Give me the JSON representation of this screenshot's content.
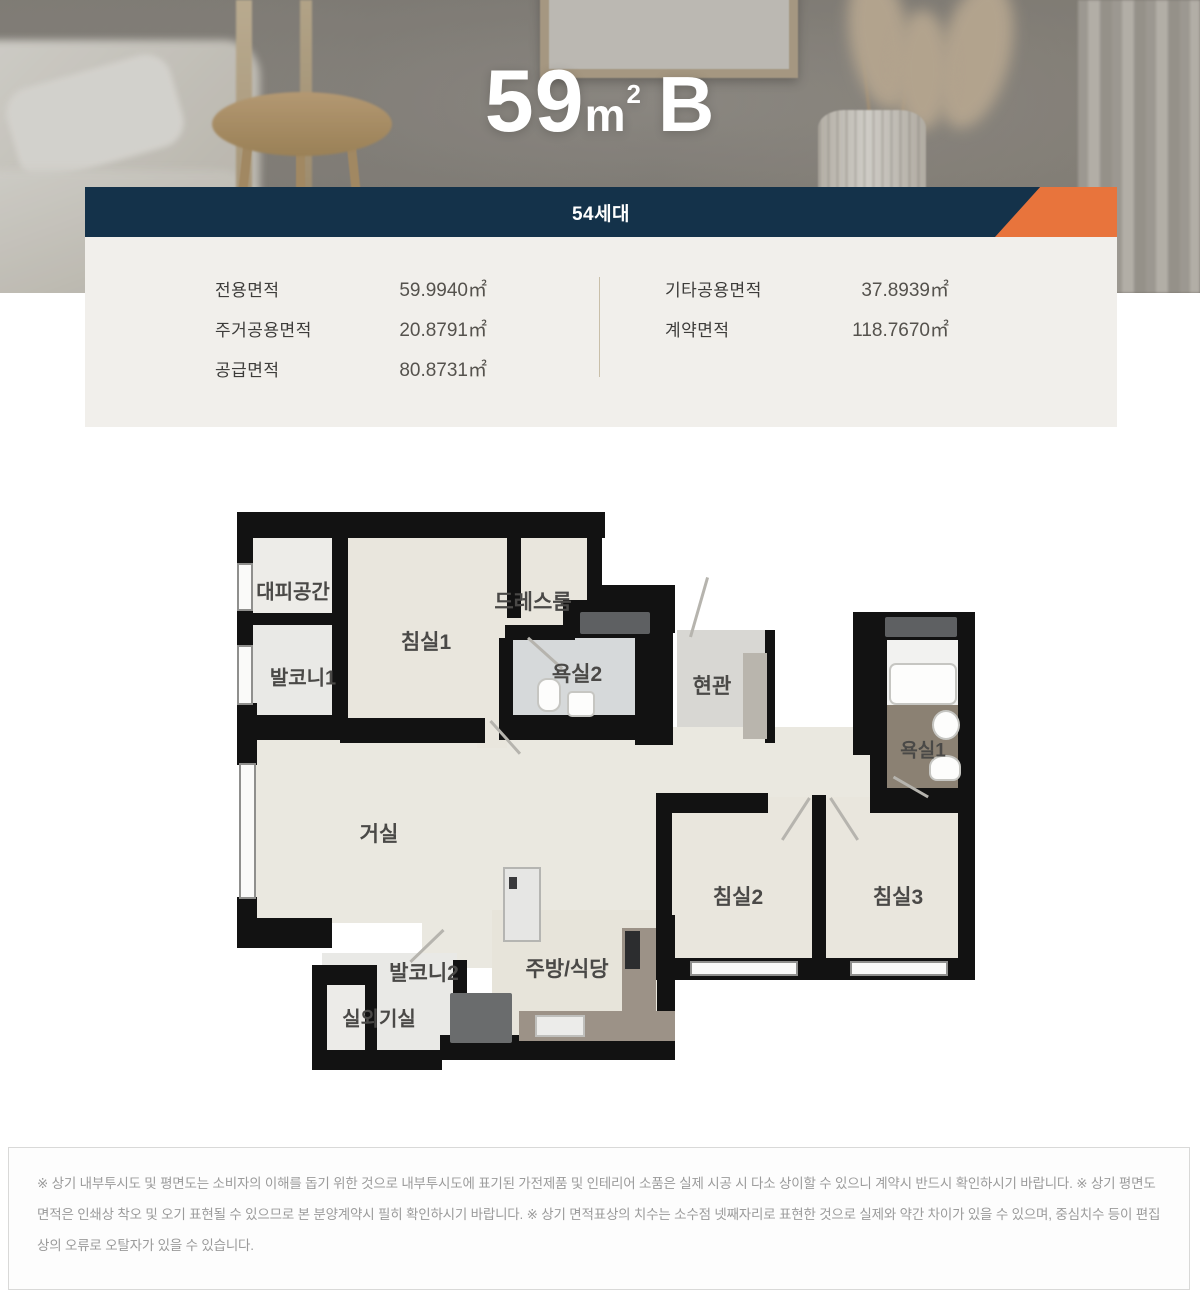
{
  "hero": {
    "title_number": "59",
    "title_unit": "m",
    "title_exponent": "2",
    "title_variant": "B"
  },
  "banner": {
    "household_count": "54세대"
  },
  "area_panel": {
    "left_rows": [
      {
        "label": "전용면적",
        "value": "59.9940㎡"
      },
      {
        "label": "주거공용면적",
        "value": "20.8791㎡"
      },
      {
        "label": "공급면적",
        "value": "80.8731㎡"
      }
    ],
    "right_rows": [
      {
        "label": "기타공용면적",
        "value": "37.8939㎡"
      },
      {
        "label": "계약면적",
        "value": "118.7670㎡"
      }
    ]
  },
  "floor_plan": {
    "rooms": [
      {
        "id": "escape",
        "label": "대피공간"
      },
      {
        "id": "balcony1",
        "label": "발코니1"
      },
      {
        "id": "bedroom1",
        "label": "침실1"
      },
      {
        "id": "dressroom",
        "label": "드레스룸"
      },
      {
        "id": "bath2",
        "label": "욕실2"
      },
      {
        "id": "entrance",
        "label": "현관"
      },
      {
        "id": "bath1",
        "label": "욕실1"
      },
      {
        "id": "living",
        "label": "거실"
      },
      {
        "id": "bedroom2",
        "label": "침실2"
      },
      {
        "id": "bedroom3",
        "label": "침실3"
      },
      {
        "id": "balcony2",
        "label": "발코니2"
      },
      {
        "id": "outdoor_unit",
        "label": "실외기실"
      },
      {
        "id": "kitchen",
        "label": "주방/식당"
      }
    ]
  },
  "colors": {
    "navy": "#14324a",
    "orange": "#e8743c",
    "panel_bg": "#f1efeb",
    "wall": "#121212",
    "bath_tile": "#8b8173"
  },
  "disclaimer": {
    "text": "※ 상기 내부투시도 및 평면도는 소비자의 이해를 돕기 위한 것으로 내부투시도에 표기된 가전제품 및 인테리어 소품은 실제 시공 시 다소 상이할 수 있으니 계약시 반드시 확인하시기 바랍니다. ※ 상기 평면도 면적은 인쇄상 착오 및 오기 표현될 수 있으므로 본 분양계약시 필히 확인하시기 바랍니다. ※ 상기 면적표상의 치수는 소수점 넷째자리로 표현한 것으로 실제와 약간 차이가 있을 수 있으며, 중심치수 등이 편집상의 오류로 오탈자가 있을 수 있습니다."
  }
}
